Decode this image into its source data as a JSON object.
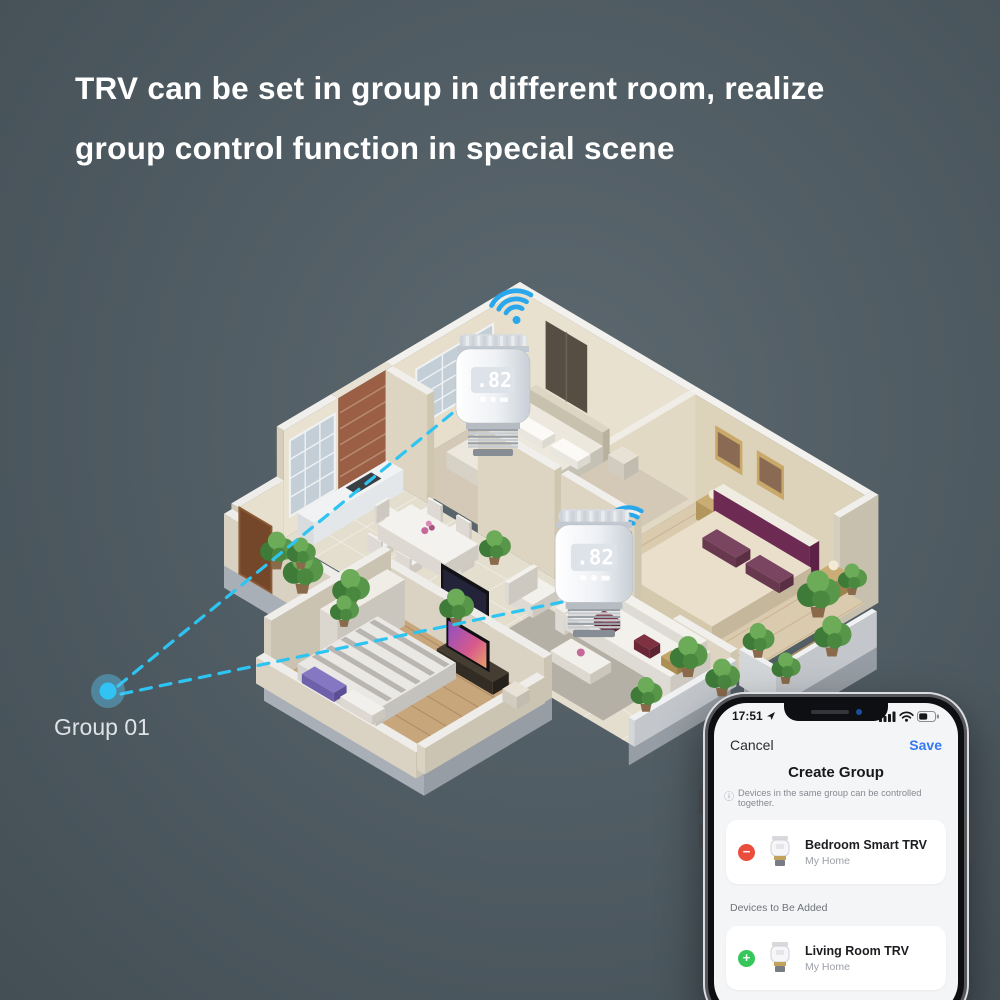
{
  "heading": {
    "line1": "TRV can be set in group in different room, realize",
    "line2": "group control function in special scene"
  },
  "floorplan": {
    "group_label": "Group 01",
    "trv_display": ".82",
    "trv_display_icons": [
      "lock",
      "valve",
      "battery"
    ],
    "wifi_icon": "wifi-signal"
  },
  "phone": {
    "status_time": "17:51",
    "status_icons": [
      "location-arrow",
      "signal-bars",
      "wifi",
      "battery"
    ],
    "cancel": "Cancel",
    "save": "Save",
    "title": "Create Group",
    "note": "Devices in the same group can be controlled together.",
    "note_icon": "info-circle",
    "section_label": "Devices to Be Added",
    "devices": [
      {
        "name": "Bedroom Smart TRV",
        "home": "My Home",
        "action_icon": "minus-circle",
        "action": "−"
      },
      {
        "name": "Living Room TRV",
        "home": "My Home",
        "action_icon": "plus-circle",
        "action": "+"
      }
    ]
  },
  "colors": {
    "dashed_cyan": "#2ec4f2",
    "wifi_blue": "#2aa7ea",
    "save_blue": "#3478f6",
    "remove_red": "#eb4d3d",
    "add_green": "#35c75a",
    "background": "#505c63"
  }
}
